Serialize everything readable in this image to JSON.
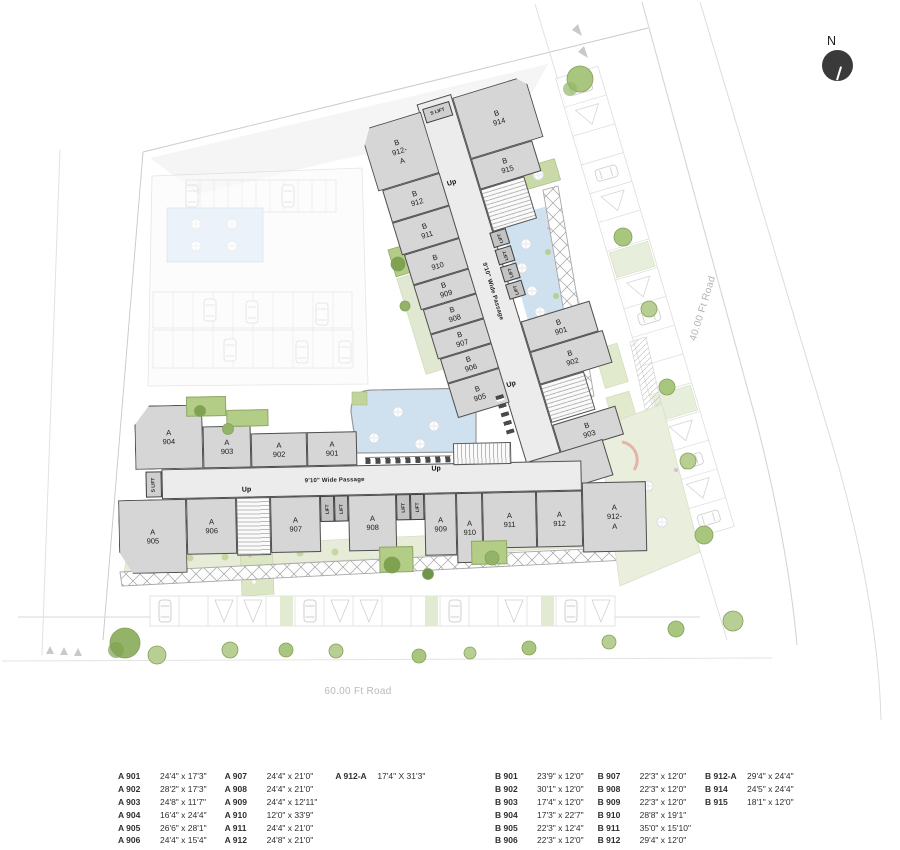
{
  "north": {
    "label": "N"
  },
  "roads": {
    "bottom": "60.00 Ft Road",
    "right": "40.00 Ft Road"
  },
  "shared": {
    "up": "Up",
    "lift": "LIFT",
    "s_lift": "S LIFT",
    "passage": "9'10\" Wide Passage"
  },
  "buildings": {
    "b": {
      "west": [
        "B 912-A",
        "B 912",
        "B 911",
        "B 910",
        "B 909",
        "B 908",
        "B 907",
        "B 906",
        "B 905"
      ],
      "east": [
        "B 914",
        "B 915",
        "B 901",
        "B 902",
        "B 903",
        "B 904"
      ]
    },
    "a": {
      "north": [
        "A 904",
        "A 903",
        "A 902",
        "A 901"
      ],
      "south": [
        "A 905",
        "A 906",
        "A 907",
        "A 908",
        "A 909",
        "A 910",
        "A 911",
        "A 912",
        "A 912-A"
      ]
    }
  },
  "legend": {
    "a": [
      {
        "id": "A 901",
        "size": "24'4\" x 17'3\""
      },
      {
        "id": "A 902",
        "size": "28'2\" x 17'3\""
      },
      {
        "id": "A 903",
        "size": "24'8\" x 11'7\""
      },
      {
        "id": "A 904",
        "size": "16'4\" x 24'4\""
      },
      {
        "id": "A 905",
        "size": "26'6\" x 28'1\""
      },
      {
        "id": "A 906",
        "size": "24'4\" x 15'4\""
      },
      {
        "id": "A 907",
        "size": "24'4\" x 21'0\""
      },
      {
        "id": "A 908",
        "size": "24'4\" x 21'0\""
      },
      {
        "id": "A 909",
        "size": "24'4\" x 12'11\""
      },
      {
        "id": "A 910",
        "size": "12'0\" x 33'9\""
      },
      {
        "id": "A 911",
        "size": "24'4\" x 21'0\""
      },
      {
        "id": "A 912",
        "size": "24'8\" x 21'0\""
      },
      {
        "id": "A 912-A",
        "size": "17'4\" X 31'3\""
      }
    ],
    "b": [
      {
        "id": "B 901",
        "size": "23'9\" x 12'0\""
      },
      {
        "id": "B 902",
        "size": "30'1\" x 12'0\""
      },
      {
        "id": "B 903",
        "size": "17'4\" x 12'0\""
      },
      {
        "id": "B 904",
        "size": "17'3\" x 22'7\""
      },
      {
        "id": "B 905",
        "size": "22'3\" x 12'4\""
      },
      {
        "id": "B 906",
        "size": "22'3\" x 12'0\""
      },
      {
        "id": "B 907",
        "size": "22'3\" x 12'0\""
      },
      {
        "id": "B 908",
        "size": "22'3\" x 12'0\""
      },
      {
        "id": "B 909",
        "size": "22'3\" x 12'0\""
      },
      {
        "id": "B 910",
        "size": "28'8\" x 19'1\""
      },
      {
        "id": "B 911",
        "size": "35'0\" x 15'10\""
      },
      {
        "id": "B 912",
        "size": "29'4\" x 12'0\""
      },
      {
        "id": "B 912-A",
        "size": "29'4\" x 24'4\""
      },
      {
        "id": "B 914",
        "size": "24'5\" x 24'4\""
      },
      {
        "id": "B 915",
        "size": "18'1\" x 12'0\""
      }
    ]
  },
  "colors": {
    "room": "#d6d6d6",
    "wall": "#4f4f4f",
    "passage_fill": "#ececec",
    "water": "#cfe0ee",
    "green_bright": "#b3cc86",
    "green_pale": "#e6ecd8",
    "tree": "#a9c67f",
    "north_circle": "#3a3a3a"
  }
}
